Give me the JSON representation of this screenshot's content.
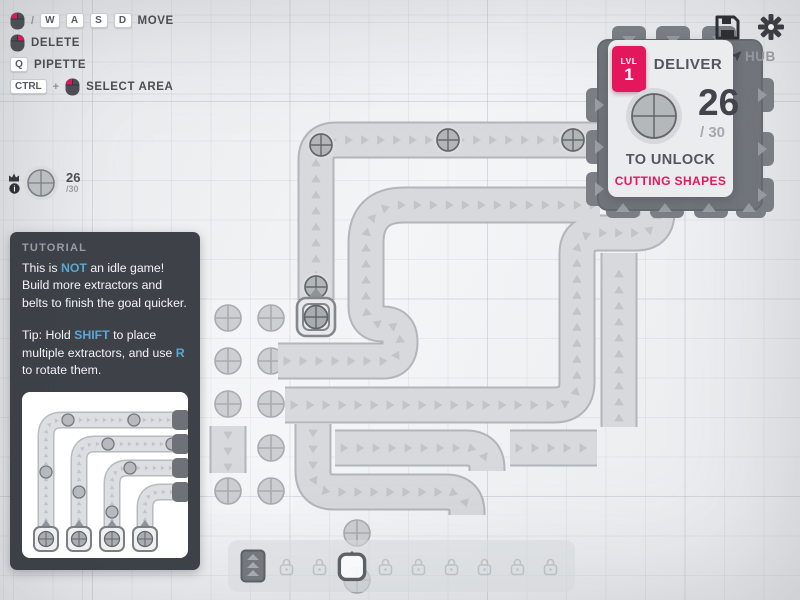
{
  "hints": {
    "move": {
      "separator": "/",
      "keys": [
        "W",
        "A",
        "S",
        "D"
      ],
      "label": "MOVE"
    },
    "delete": {
      "label": "DELETE"
    },
    "pipette": {
      "key": "Q",
      "label": "PIPETTE"
    },
    "select_area": {
      "key": "CTRL",
      "plus": "+",
      "label": "SELECT AREA"
    }
  },
  "pinned_goal": {
    "current": "26",
    "total": "/30"
  },
  "hub": {
    "label": "HUB",
    "panel": {
      "level_label": "LVL",
      "level": "1",
      "title": "DELIVER",
      "amount": "26",
      "of_total": "/ 30",
      "unlock_text": "TO UNLOCK",
      "reward": "CUTTING SHAPES"
    }
  },
  "tutorial": {
    "title": "TUTORIAL",
    "p1": [
      {
        "t": "This is "
      },
      {
        "t": "NOT",
        "h": true
      },
      {
        "t": " an idle game! Build more extractors and belts to finish the goal quicker."
      }
    ],
    "p2": [
      {
        "t": "Tip: Hold "
      },
      {
        "t": "SHIFT",
        "h": true
      },
      {
        "t": " to place multiple extractors, and use "
      },
      {
        "t": "R",
        "h": true
      },
      {
        "t": " to rotate them."
      }
    ]
  },
  "toolbar": {
    "slots": [
      "belt",
      "locked",
      "locked",
      "extractor-selected",
      "locked",
      "locked",
      "locked",
      "locked",
      "locked",
      "locked"
    ]
  },
  "colors": {
    "accent": "#e5175c",
    "link": "#5ba7d1",
    "belt": "#d7d9dc",
    "hub_body": "#71757b"
  }
}
